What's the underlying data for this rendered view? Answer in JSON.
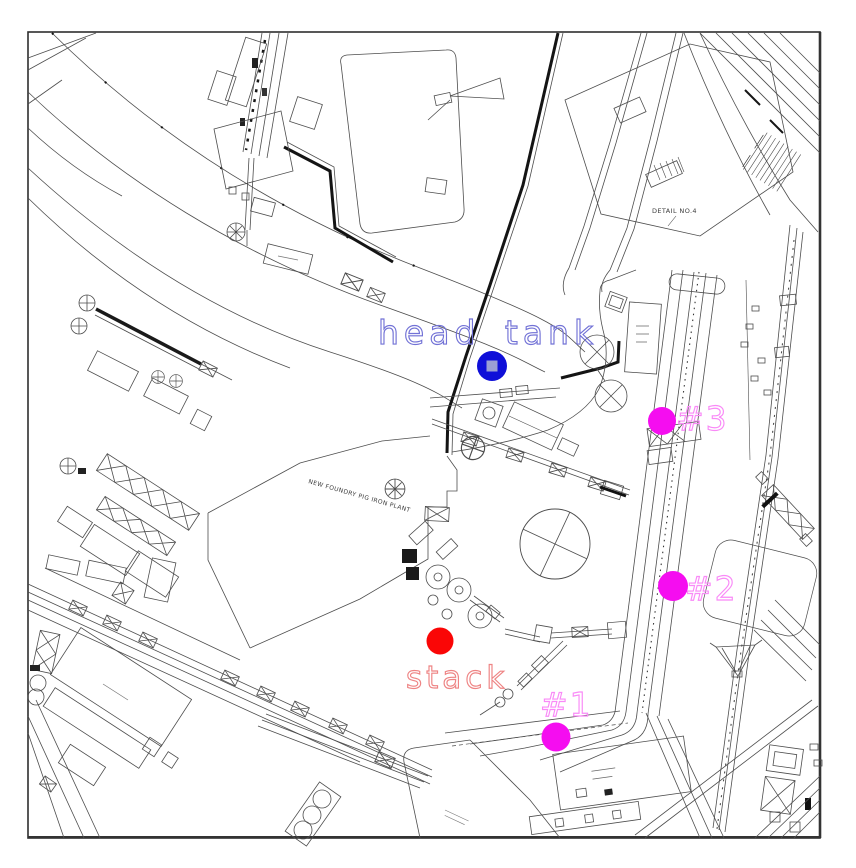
{
  "image_kind": "annotated industrial site plan (CAD plot) with sampling location markers",
  "annotations": {
    "head_tank": {
      "label": "head tank",
      "text_color": "#7272d6",
      "dot_color": "#0f0fd8"
    },
    "stack": {
      "label": "stack",
      "text_color": "#ee8484",
      "dot_color": "#fa0606"
    },
    "points": {
      "label_color": "#f98af7",
      "dot_color": "#f50df0",
      "items": [
        {
          "label": "#1"
        },
        {
          "label": "#2"
        },
        {
          "label": "#3"
        }
      ]
    }
  },
  "drawing_labels": {
    "detail_note": "DETAIL NO.4",
    "plant_name": "NEW FOUNDRY PIG IRON PLANT"
  }
}
